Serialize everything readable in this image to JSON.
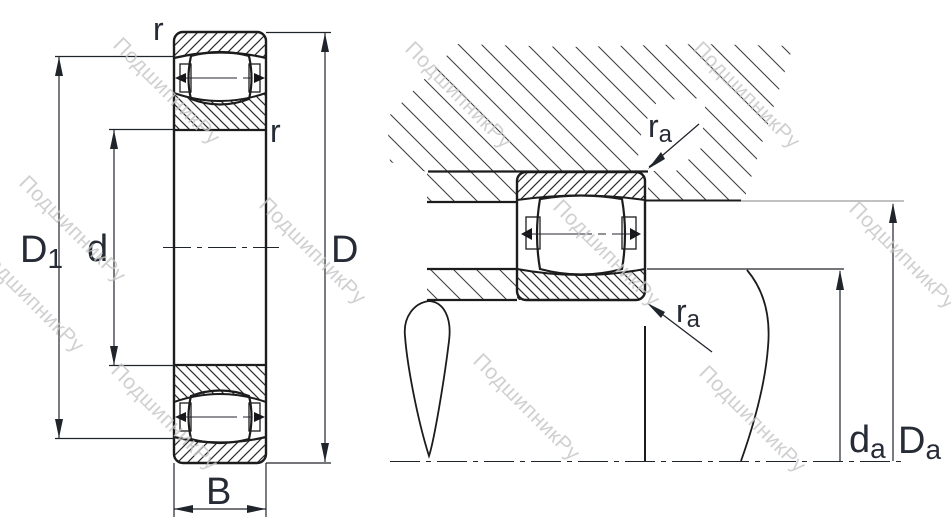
{
  "drawing": {
    "type": "bearing-mounting-dimension-diagram",
    "views": [
      "bearing-cross-section",
      "mounted-arrangement"
    ]
  },
  "colors": {
    "outline": "#1c1c1e",
    "dimension": "#20242b",
    "label": "#262b36",
    "hatch_dense": "#2b2b2b",
    "hatch_wide": "#3d3d3d",
    "gray_reference": "#9c9c9c",
    "watermark": "#c5c5c5",
    "background": "#ffffff"
  },
  "watermark": {
    "text": "ПодшипникРу"
  },
  "left_view": {
    "labels": {
      "r_top": "r",
      "r_side": "r",
      "d1_main": "D",
      "d1_sub": "1",
      "d": "d",
      "D": "D",
      "B": "B"
    }
  },
  "right_view": {
    "labels": {
      "ra_top_main": "r",
      "ra_top_sub": "a",
      "ra_bottom_main": "r",
      "ra_bottom_sub": "a",
      "da_main": "d",
      "da_sub": "a",
      "Da_main": "D",
      "Da_sub": "a"
    }
  }
}
